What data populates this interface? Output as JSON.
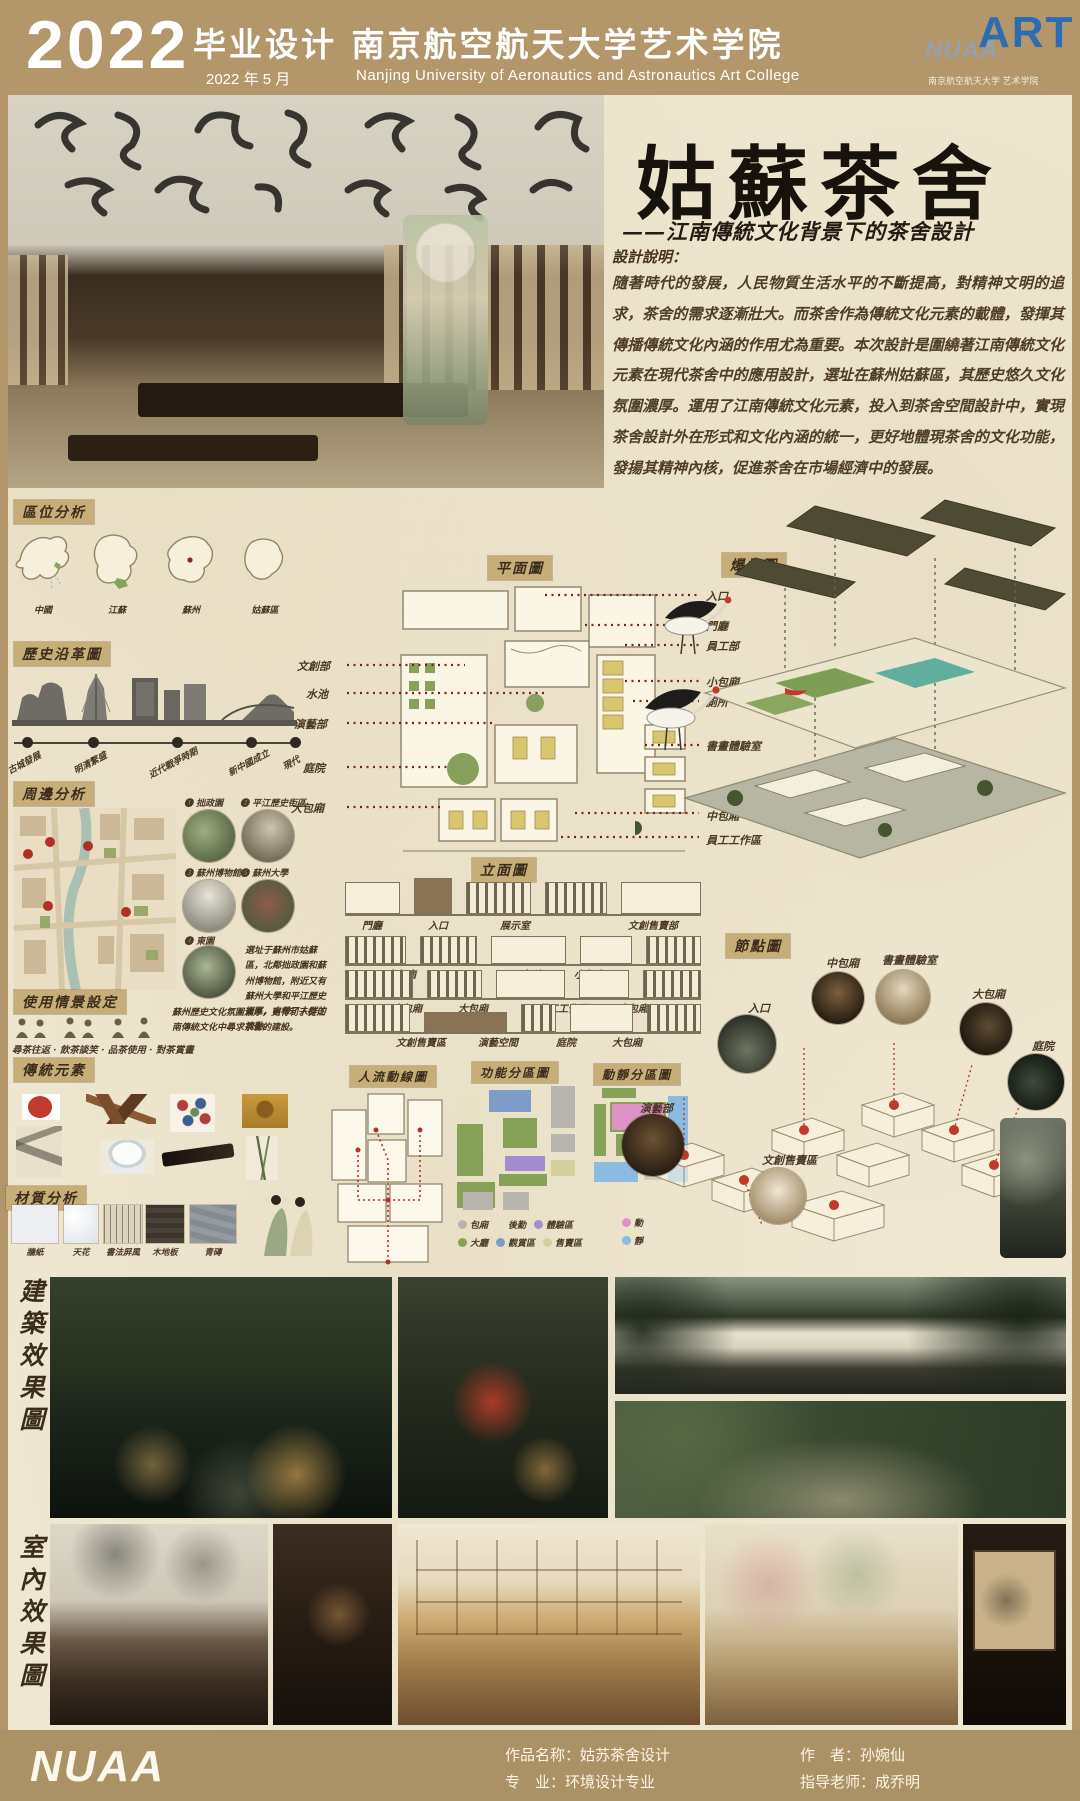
{
  "header": {
    "year": "2022",
    "title_cn": "毕业设计  南京航空航天大学艺术学院",
    "date_cn": "2022 年 5 月",
    "title_en": "Nanjing  University  of  Aeronautics  and  Astronautics  Art  College",
    "logo": {
      "nuaa": "NUAA",
      "art": "ART",
      "caption": "南京航空航天大学  艺术学院"
    }
  },
  "hero": {
    "title": "姑蘇茶舍",
    "subtitle": "——江南傳統文化背景下的茶舍設計",
    "desc_title": "設計說明：",
    "desc": "隨著時代的發展，人民物質生活水平的不斷提高，對精神文明的追求，茶舍的需求逐漸壯大。而茶舍作為傳統文化元素的載體，發揮其傳播傳統文化內涵的作用尤為重要。本次設計是圍繞著江南傳統文化元素在現代茶舍中的應用設計，選址在蘇州姑蘇區，其歷史悠久文化氛圍濃厚。運用了江南傳統文化元素，投入到茶舍空間設計中，實現茶舍設計外在形式和文化內涵的統一，更好地體現茶舍的文化功能，發揚其精神內核，促進茶舍在市場經濟中的發展。"
  },
  "location": {
    "title": "區位分析",
    "maps": [
      "中國",
      "江蘇",
      "蘇州",
      "姑蘇區"
    ]
  },
  "history": {
    "title": "歷史沿革圖",
    "events": [
      "古城發展",
      "明清繁盛",
      "近代戰爭時期",
      "新中國成立",
      "現代"
    ]
  },
  "surroundings": {
    "title": "周邊分析",
    "spots": [
      "❶ 拙政園",
      "❷ 平江歷史街區",
      "❸ 蘇州博物館",
      "❺ 蘇州大學",
      "❹ 東園"
    ],
    "note1": "選址于蘇州市姑蘇區，北鄰拙政園和蘇州博物館，附近又有蘇州大學和平江歷史街區，自帶了人群的流動。",
    "note2": "蘇州歷史文化氛圍濃厚，更有利于從江南傳統文化中尋求茶舍的建設。"
  },
  "scenario": {
    "title": "使用情景設定",
    "caption": "尋茶往返 · 飲茶談笑 · 品茶使用 · 對茶賞畫"
  },
  "elements": {
    "title": "傳統元素",
    "items": [
      "印章",
      "山水畫",
      "木雕構件",
      "花卉紋樣",
      "佛像畫",
      "蓋碗茶具",
      "古琴",
      "竹枝"
    ]
  },
  "materials": {
    "title": "材質分析",
    "items": [
      "牆紙",
      "天花",
      "書法屏風",
      "木地板",
      "青磚"
    ]
  },
  "plan": {
    "title": "平面圖",
    "left_labels": [
      "文創部",
      "水池",
      "演藝部",
      "庭院",
      "大包廂"
    ],
    "right_labels": [
      "入口",
      "門廳",
      "員工部",
      "小包廂",
      "廁所",
      "書畫體驗室",
      "中包廂",
      "員工工作區"
    ]
  },
  "elevation": {
    "title": "立面圖",
    "row1": [
      "門廳",
      "入口",
      "展示室",
      "文創售賣部"
    ],
    "row2": [
      "中包廂",
      "廁所",
      "小包廂"
    ],
    "row3": [
      "大包廂",
      "大包廂",
      "員工工作區",
      "中包廂"
    ],
    "row4": [
      "文創售賣區",
      "演藝空間",
      "庭院",
      "大包廂"
    ]
  },
  "diagrams": {
    "circulation_title": "人流動線圖",
    "function_title": "功能分區圖",
    "function_legend": [
      {
        "label": "包廂",
        "color": "#b7b5ad"
      },
      {
        "label": "後勤",
        "color": "#e6e2c3"
      },
      {
        "label": "體驗區",
        "color": "#a58bd0"
      },
      {
        "label": "大廳",
        "color": "#87a159"
      },
      {
        "label": "觀賞區",
        "color": "#7d9dc8"
      },
      {
        "label": "售賣區",
        "color": "#d5cf9b"
      }
    ],
    "quiet_title": "動靜分區圖",
    "quiet_legend": [
      {
        "label": "動",
        "color": "#df92c6"
      },
      {
        "label": "靜",
        "color": "#8cbbe1"
      }
    ]
  },
  "axon": {
    "exploded_title": "爆炸圖",
    "node_title": "節點圖",
    "nodes": [
      "入口",
      "中包廂",
      "書畫體驗室",
      "大包廂",
      "庭院",
      "演藝部",
      "文創售賣區"
    ]
  },
  "renders": {
    "arch_label": "建築效果圖",
    "interior_label": "室內效果圖"
  },
  "footer": {
    "logo": "NUAA",
    "items": [
      {
        "label": "作品名称：",
        "value": "姑苏茶舍设计"
      },
      {
        "label": "专　业：",
        "value": "环境设计专业"
      },
      {
        "label": "作　者：",
        "value": "孙婉仙"
      },
      {
        "label": "指导老师：",
        "value": "成乔明"
      }
    ]
  }
}
